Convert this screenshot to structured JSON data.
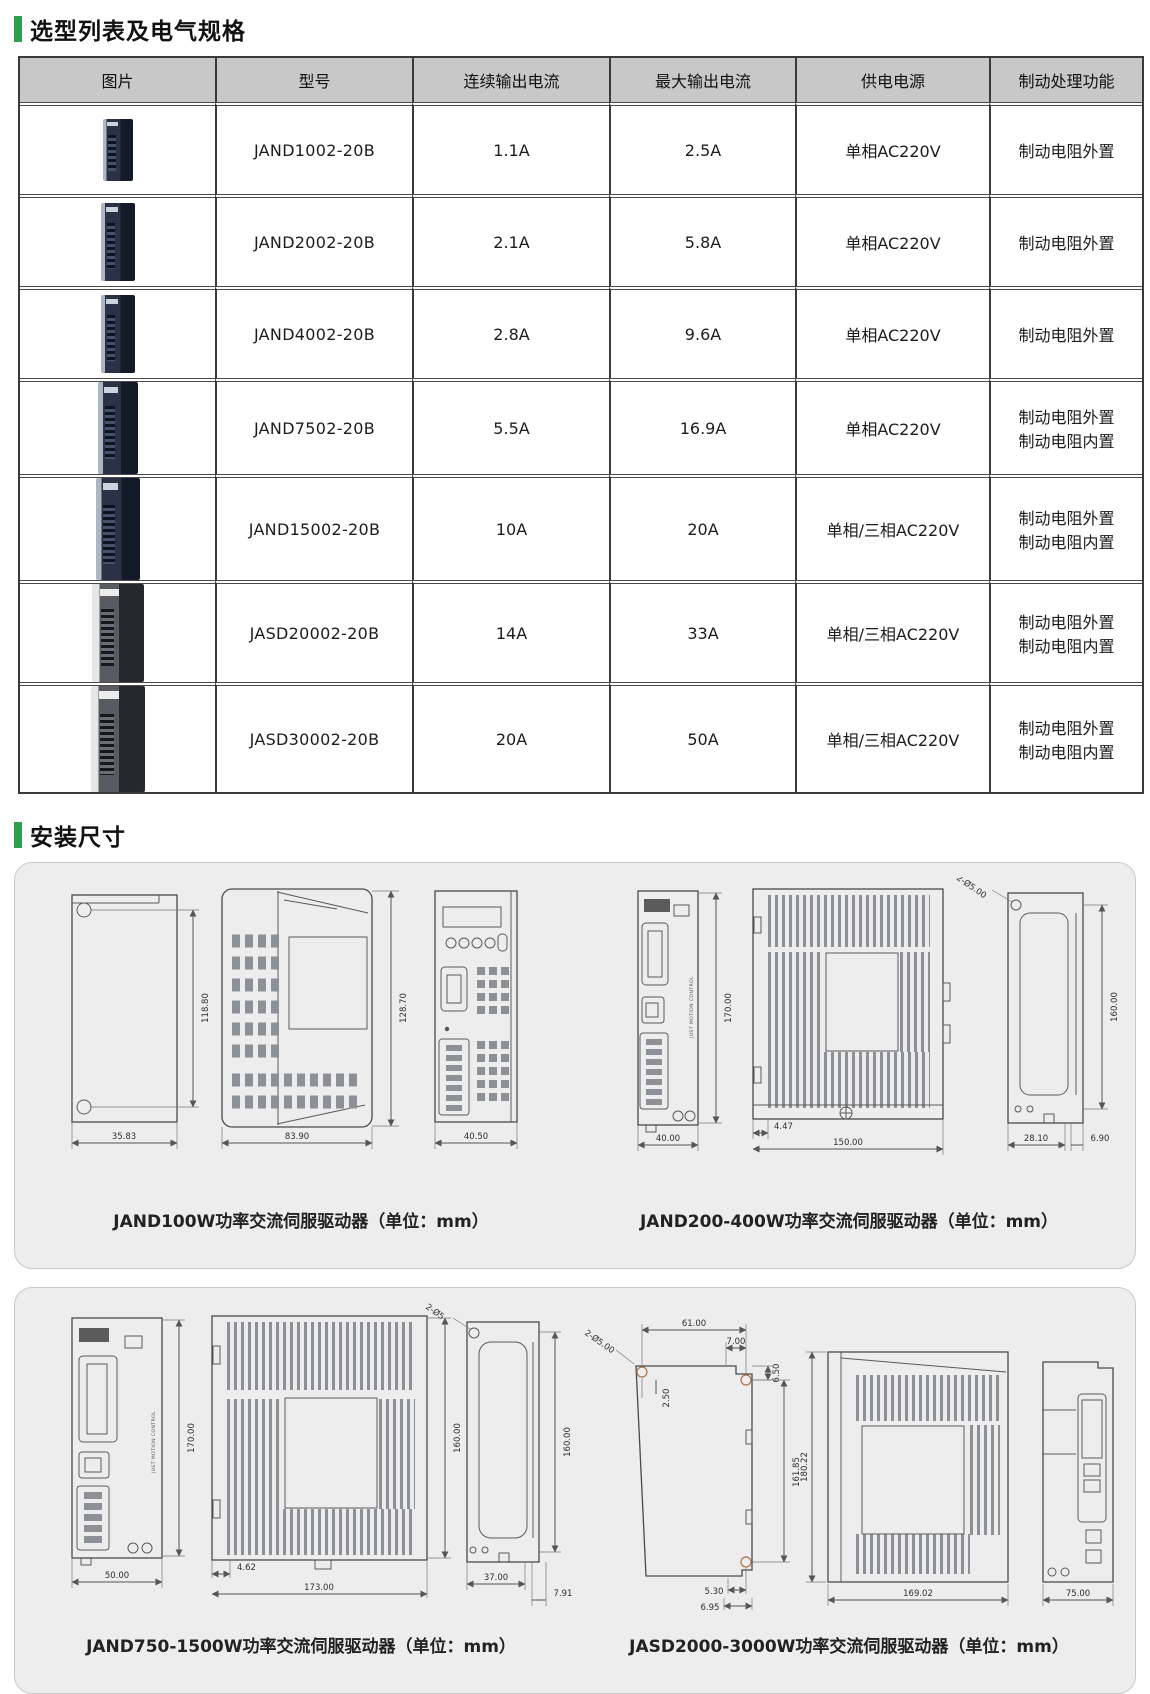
{
  "colors": {
    "accent_green": "#2f9e4e",
    "table_header_bg": "#c8c8c8",
    "panel_bg": "#ededed",
    "line": "#4a4a4a"
  },
  "section1": {
    "title": "选型列表及电气规格"
  },
  "table": {
    "headers": [
      "图片",
      "型号",
      "连续输出电流",
      "最大输出电流",
      "供电电源",
      "制动处理功能"
    ],
    "rows": [
      {
        "model": "JAND1002-20B",
        "cont": "1.1A",
        "max": "2.5A",
        "power": "单相AC220V",
        "brake": "制动电阻外置"
      },
      {
        "model": "JAND2002-20B",
        "cont": "2.1A",
        "max": "5.8A",
        "power": "单相AC220V",
        "brake": "制动电阻外置"
      },
      {
        "model": "JAND4002-20B",
        "cont": "2.8A",
        "max": "9.6A",
        "power": "单相AC220V",
        "brake": "制动电阻外置"
      },
      {
        "model": "JAND7502-20B",
        "cont": "5.5A",
        "max": "16.9A",
        "power": "单相AC220V",
        "brake": "制动电阻外置\n制动电阻内置"
      },
      {
        "model": "JAND15002-20B",
        "cont": "10A",
        "max": "20A",
        "power": "单相/三相AC220V",
        "brake": "制动电阻外置\n制动电阻内置"
      },
      {
        "model": "JASD20002-20B",
        "cont": "14A",
        "max": "33A",
        "power": "单相/三相AC220V",
        "brake": "制动电阻外置\n制动电阻内置"
      },
      {
        "model": "JASD30002-20B",
        "cont": "20A",
        "max": "50A",
        "power": "单相/三相AC220V",
        "brake": "制动电阻外置\n制动电阻内置"
      }
    ]
  },
  "section2": {
    "title": "安装尺寸"
  },
  "install": {
    "brand_text": "JUST MOTION CONTROL",
    "panel1": {
      "caption_left": "JAND100W功率交流伺服驱动器（单位：mm）",
      "caption_right": "JAND200-400W功率交流伺服驱动器（单位：mm）"
    },
    "panel2": {
      "caption_left": "JAND750-1500W功率交流伺服驱动器（单位：mm）",
      "caption_right": "JASD2000-3000W功率交流伺服驱动器（单位：mm）"
    }
  },
  "dimensions": {
    "jand100w": {
      "side_h": "118.80",
      "side_w": "35.83",
      "top_h": "128.70",
      "top_w": "83.90",
      "front_w": "40.50"
    },
    "jand200_400w": {
      "front_h": "170.00",
      "front_w": "40.00",
      "side_off": "4.47",
      "side_w": "150.00",
      "back_holes": "2-Ø5.00",
      "back_h": "160.00",
      "back_w": "28.10",
      "back_t": "6.90"
    },
    "jand750_1500w": {
      "front_h": "170.00",
      "front_w": "50.00",
      "side_h": "160.00",
      "side_off": "4.62",
      "side_w": "173.00",
      "back_holes": "2-Ø5",
      "back_h": "160.00",
      "back_w": "37.00",
      "back_t": "7.91"
    },
    "jasd2000_3000w": {
      "plate_w1": "61.00",
      "plate_w2": "7.00",
      "plate_step": "6.50",
      "plate_off": "2.50",
      "plate_holes": "2-Ø5.00",
      "plate_h": "161.85",
      "plate_b1": "5.30",
      "plate_b2": "6.95",
      "side_h": "180.22",
      "side_w": "169.02",
      "front_w": "75.00"
    }
  }
}
